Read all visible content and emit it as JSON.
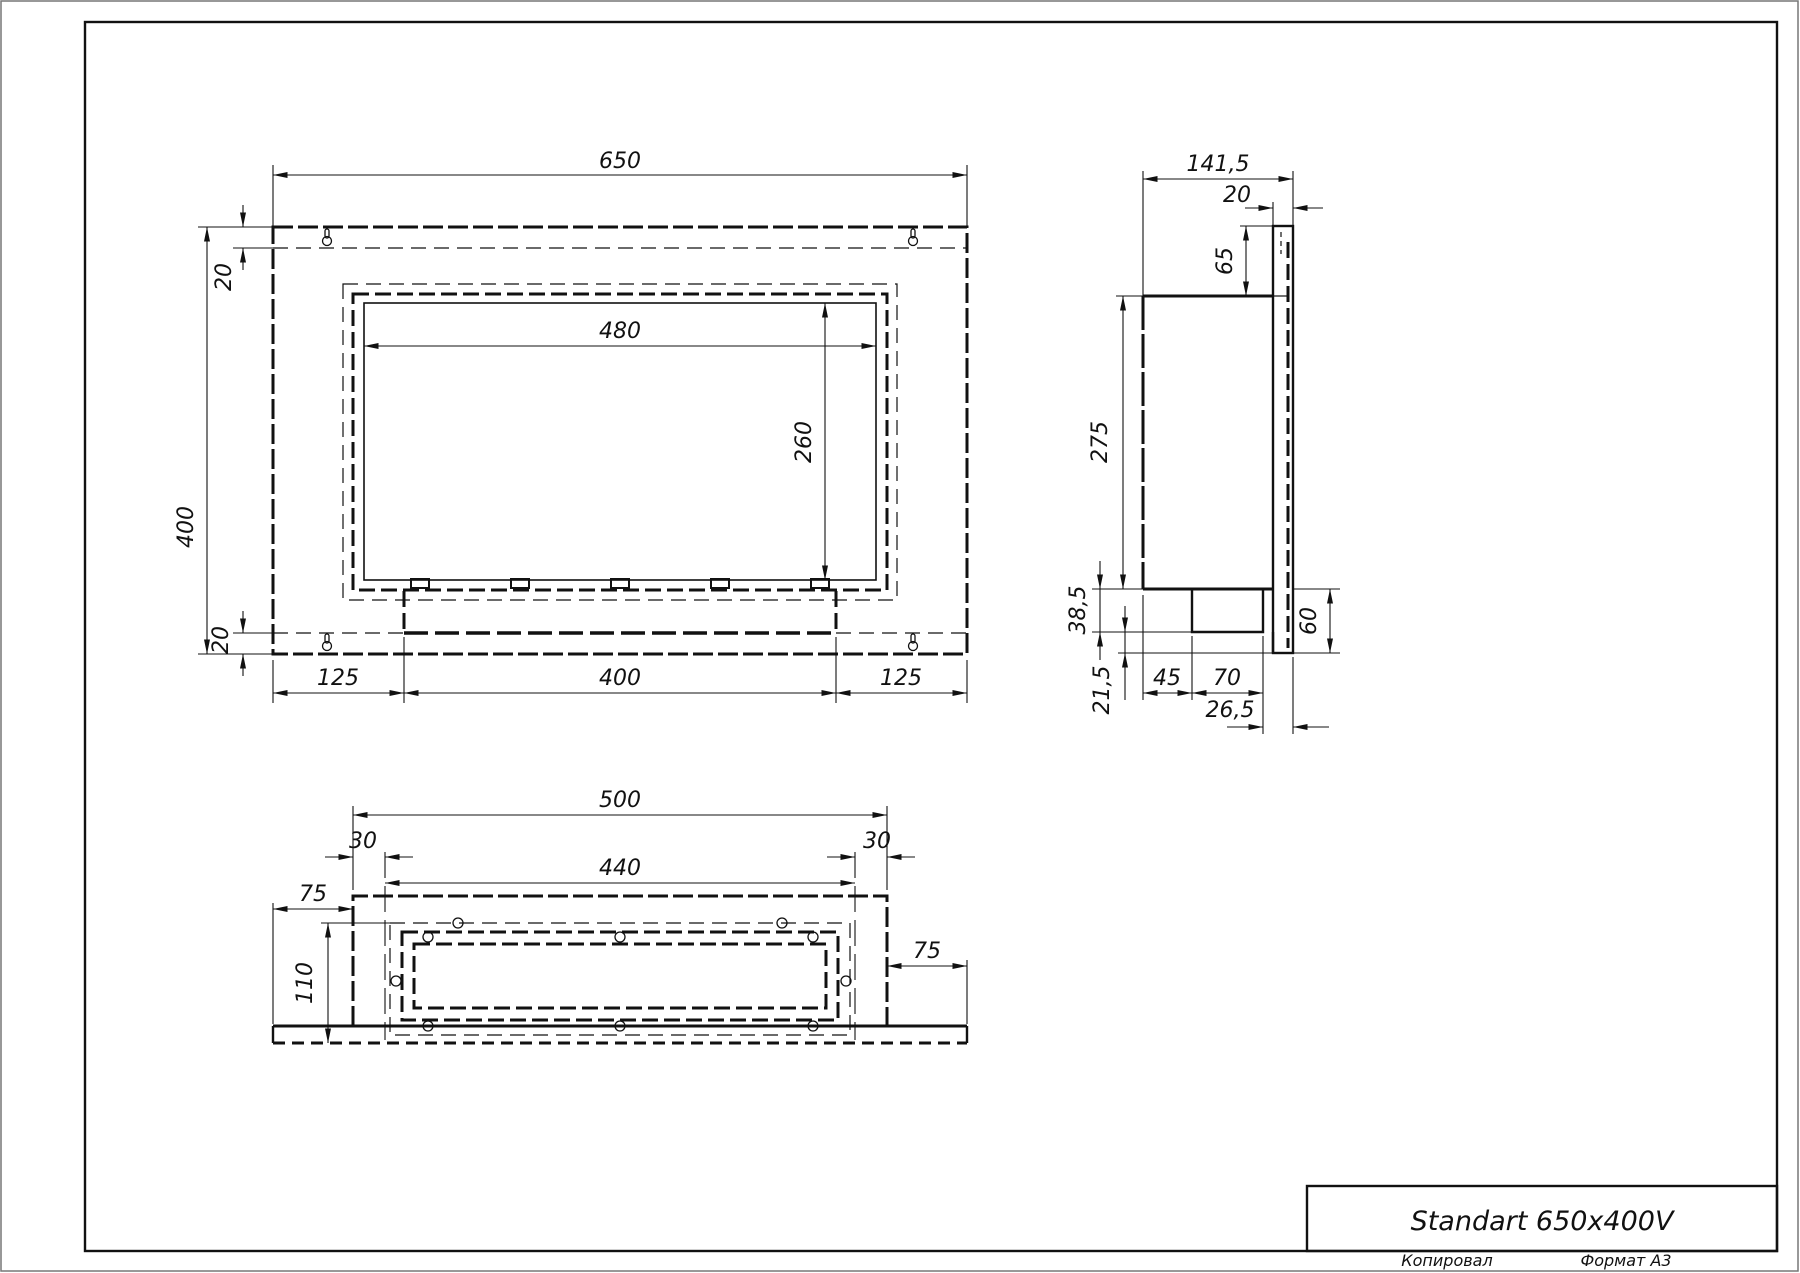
{
  "title_block": {
    "title": "Standart 650x400V",
    "copied_label": "Копировал",
    "format_label": "Формат А3"
  },
  "front_view": {
    "dims": {
      "overall_width": "650",
      "overall_height": "400",
      "top_inset": "20",
      "bottom_inset": "20",
      "opening_width": "480",
      "opening_height": "260",
      "bottom_left_margin": "125",
      "bottom_slot_width": "400",
      "bottom_right_margin": "125"
    }
  },
  "side_view": {
    "dims": {
      "overall_depth": "141,5",
      "flange_depth": "20",
      "top_offset": "65",
      "body_height": "275",
      "burner_box_height": "38,5",
      "bottom_gap": "21,5",
      "burner_offset": "45",
      "burner_depth": "70",
      "burner_to_wall": "26,5",
      "flange_bottom_height": "60"
    }
  },
  "bottom_view": {
    "dims": {
      "body_width": "500",
      "left_inset": "30",
      "opening_width": "440",
      "right_inset": "30",
      "left_flange": "75",
      "niche_depth": "110",
      "right_flange": "75"
    }
  }
}
